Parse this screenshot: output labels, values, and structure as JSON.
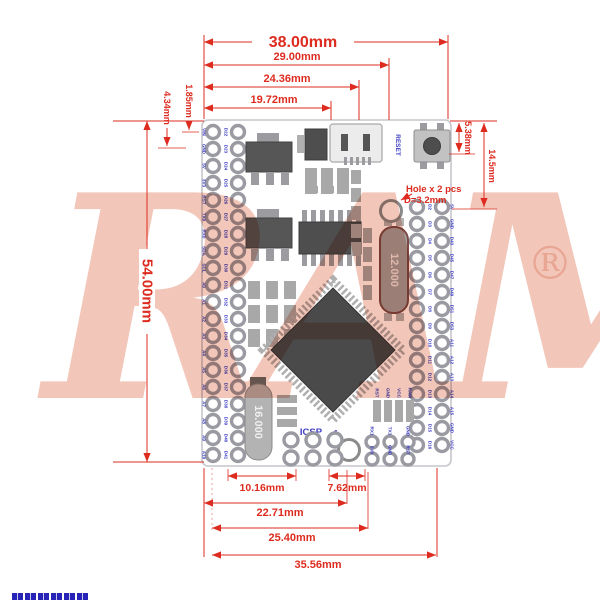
{
  "watermark": {
    "brand": "RAM",
    "registered": "®"
  },
  "dims": {
    "w_board": "38.00mm",
    "w_29": "29.00mm",
    "w_2436": "24.36mm",
    "w_1972": "19.72mm",
    "h_board": "54.00mm",
    "h_434": "4.34mm",
    "h_185": "1.85mm",
    "h_538": "5.38mm",
    "h_145": "14.5mm",
    "b_1016": "10.16mm",
    "b_762": "7.62mm",
    "b_2271": "22.71mm",
    "b_2540": "25.40mm",
    "b_3556": "35.56mm"
  },
  "hole_note": {
    "line1": "Hole x 2 pcs",
    "line2": "D=3.2mm"
  },
  "board": {
    "reset_label": "RESET",
    "icsp_label": "ICSP",
    "pin1_label": "1",
    "crystal_main": "12.000",
    "crystal_secondary": "16.000",
    "pin_labels": {
      "left_outer": [
        "VIN",
        "GND",
        "5V",
        "3V3",
        "RST",
        "TX0",
        "RX0",
        "SDA",
        "SCL",
        "A0",
        "A1",
        "A2",
        "A3",
        "A4",
        "A5",
        "A6",
        "A7",
        "A8",
        "A9",
        "A10"
      ],
      "left_inner": [
        "D22",
        "D23",
        "D24",
        "D25",
        "D26",
        "D27",
        "D28",
        "D29",
        "D30",
        "D31",
        "D32",
        "D33",
        "D34",
        "D35",
        "D36",
        "D37",
        "D38",
        "D39",
        "D40",
        "D41"
      ],
      "right_inner": [
        "D2",
        "D3",
        "D4",
        "D5",
        "D6",
        "D7",
        "D8",
        "D9",
        "D10",
        "D11",
        "D12",
        "D13",
        "D14",
        "D15",
        "D16"
      ],
      "right_outer": [
        "5V",
        "GND",
        "D43",
        "D45",
        "D47",
        "D49",
        "D51",
        "D53",
        "A11",
        "A12",
        "A13",
        "A14",
        "A15",
        "GND",
        "VCC"
      ],
      "aux": [
        "RX1",
        "TX1",
        "GND",
        "5V0",
        "GND",
        "RST"
      ],
      "smd": [
        "RST",
        "GND",
        "VCC",
        "RAW"
      ]
    }
  },
  "colors": {
    "dimension_red": "#dd2b1f",
    "silkscreen_blue": "#3d3dc4",
    "watermark_pink": "#e07a5a",
    "component_dark": "#4a4a4a",
    "pad_ring": "#9a9aa2"
  }
}
